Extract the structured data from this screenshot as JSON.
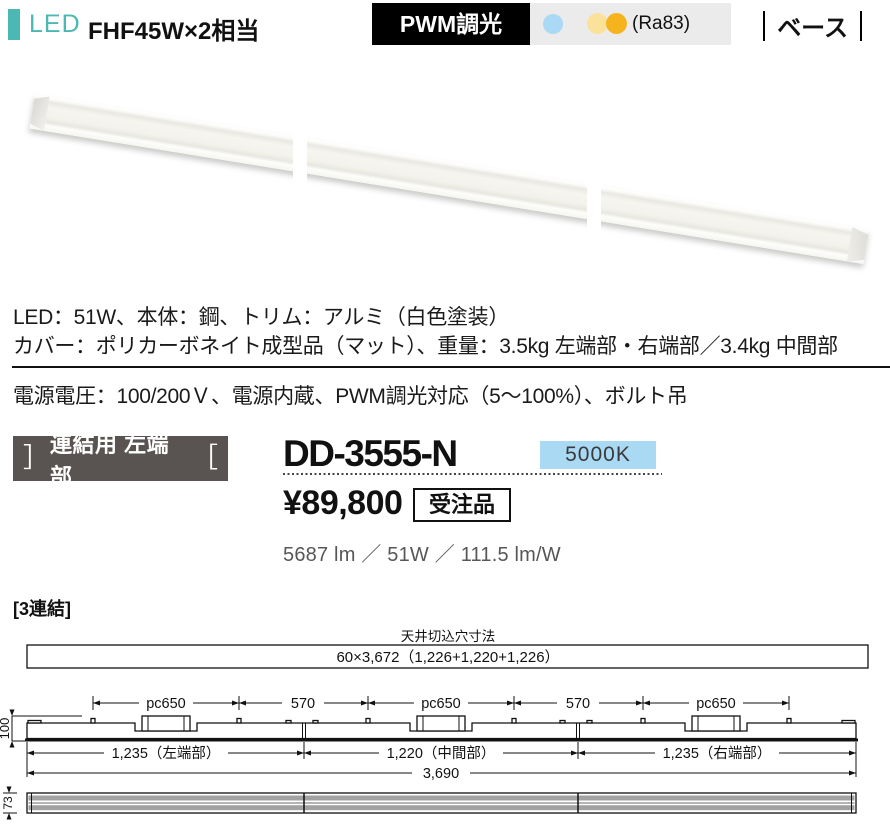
{
  "header": {
    "led_label": "LED",
    "wattage": "FHF45W×2相当",
    "dimming_badge": "PWM調光",
    "cri": "(Ra83)",
    "category": "ベース",
    "accent_teal": "#4cb8b3",
    "dot_blue": "#a9d9f4",
    "dot_yellow": "#fbe19a",
    "dot_amber": "#f5b41e"
  },
  "photo_strip": {
    "panels": 3
  },
  "specs": {
    "line1": "LED：51W、本体：鋼、トリム：アルミ（白色塗装）",
    "line2": "カバー：ポリカーボネイト成型品（マット）、重量：3.5kg 左端部・右端部／3.4kg 中間部",
    "line3": "電源電圧：100/200Ｖ、電源内蔵、PWM調光対応（5～100%）、ボルト吊"
  },
  "product": {
    "bracket_left": "］",
    "type_badge": "連結用 左端部",
    "bracket_right": "［",
    "model": "DD-3555-N",
    "color_temp": "5000K",
    "color_temp_bg": "#a9d9f3",
    "price": "¥89,800",
    "order_note": "受注品",
    "performance": "5687 lm ／ 51W ／ 111.5 lm/W"
  },
  "diagram": {
    "title": "[3連結]",
    "cutout_label": "天井切込穴寸法",
    "cutout_dim": "60×3,672（1,226+1,220+1,226）",
    "pitch_labels": [
      "pc650",
      "570",
      "pc650",
      "570",
      "pc650"
    ],
    "height_dim": "100",
    "section_dims": [
      "1,235（左端部）",
      "1,220（中間部）",
      "1,235（右端部）"
    ],
    "total_dim": "3,690",
    "bottom_height_dim": "73"
  }
}
